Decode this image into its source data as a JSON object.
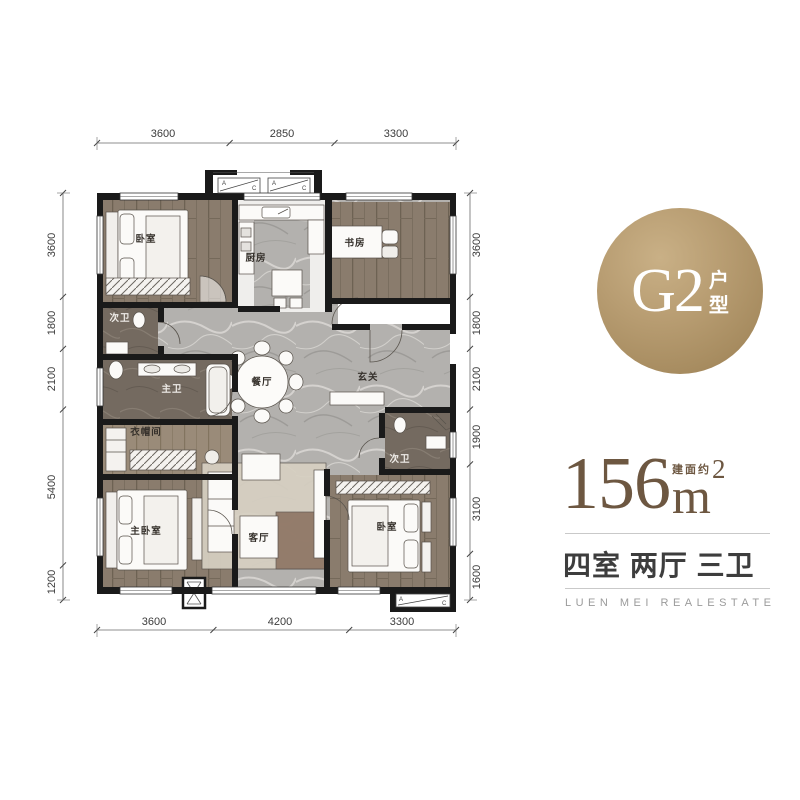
{
  "badge": {
    "code": "G2",
    "suffix_chars": [
      "户",
      "型"
    ]
  },
  "area": {
    "value": "156",
    "unit": "m",
    "sup": "2",
    "approx_label": "建面约"
  },
  "rooms_line": "四室 两厅 三卫",
  "brand": "LUEN MEI REALESTATE",
  "accent_colors": {
    "gold": "#b89d72",
    "brown": "#6d5741",
    "wall": "#1a1a1a"
  },
  "plan": {
    "dims": {
      "top": [
        "3600",
        "2850",
        "3300"
      ],
      "bottom": [
        "3600",
        "4200",
        "3300"
      ],
      "left": [
        "3600",
        "1800",
        "2100",
        "5400",
        "1200"
      ],
      "right": [
        "3600",
        "1800",
        "2100",
        "1900",
        "3100",
        "1600"
      ]
    },
    "rooms": {
      "bedroom_tl": "卧室",
      "kitchen": "厨房",
      "study": "书房",
      "bath_left": "次卫",
      "master_bath": "主卫",
      "cloakroom": "衣帽间",
      "dining": "餐厅",
      "foyer": "玄关",
      "bath_right": "次卫",
      "master_bedroom": "主卧室",
      "living": "客厅",
      "bedroom_br": "卧室"
    },
    "ac": {
      "a": "A",
      "c": "C"
    }
  }
}
